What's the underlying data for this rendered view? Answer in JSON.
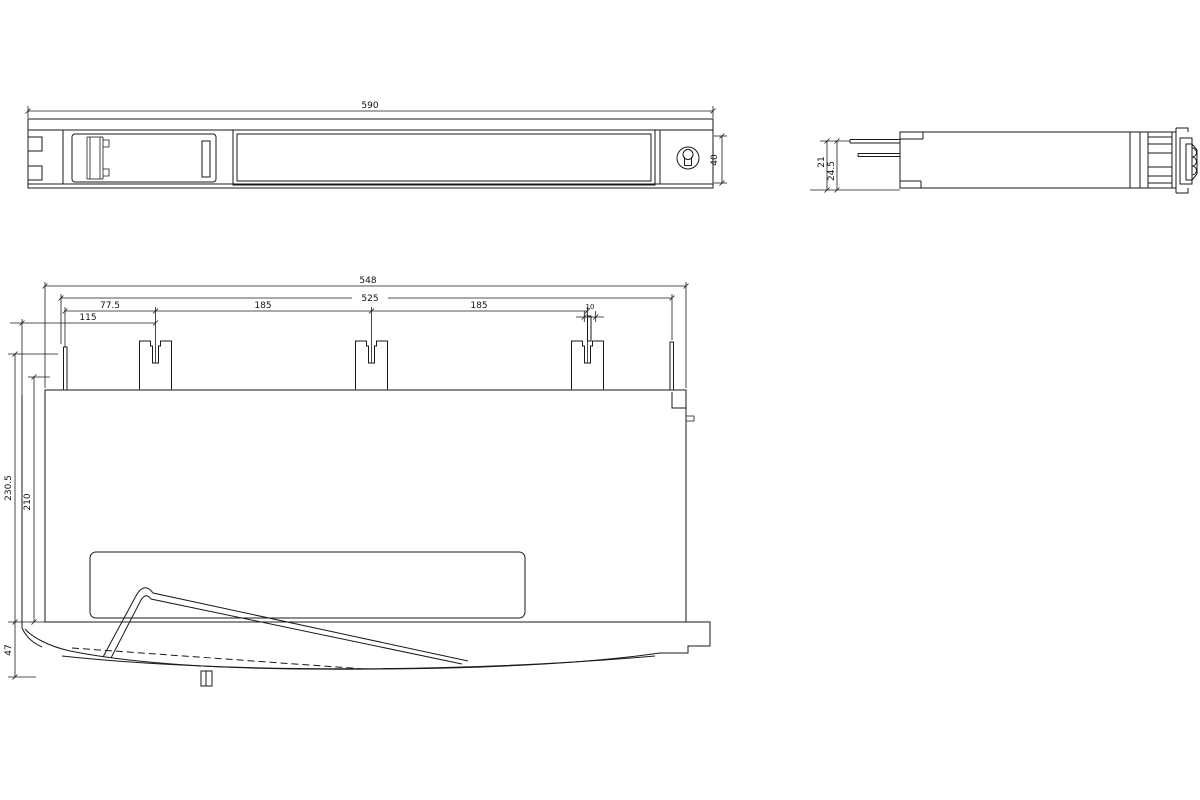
{
  "drawing": {
    "kind": "dimensional technical drawing, three orthographic views of a mounting rack rail",
    "background_color": "#ffffff",
    "line_color": "#1a1a1a",
    "views": {
      "top_view": {
        "label": "top view",
        "dims": {
          "length": "590",
          "height": "40"
        }
      },
      "side_view": {
        "label": "side view",
        "dims": {
          "inner_offset": "21",
          "outer_offset": "24.5"
        }
      },
      "front_view": {
        "label": "front view",
        "dims": {
          "overall_width": "548",
          "mounting_width": "525",
          "clip_offset_left": "77.5",
          "clip_pitch_1": "185",
          "clip_pitch_2": "185",
          "edge_offset": "115",
          "pin_offset": "10",
          "overall_height": "230.5",
          "body_height": "210",
          "duct_height": "47"
        }
      }
    }
  }
}
